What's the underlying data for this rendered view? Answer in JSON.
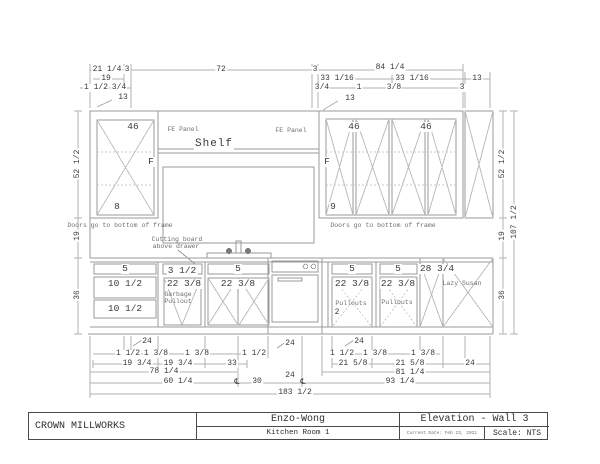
{
  "title_block": {
    "company": "CROWN MILLWORKS",
    "client": "Enzo-Wong",
    "room": "Kitchen Room 1",
    "sheet": "Elevation - Wall 3",
    "date": "Current Date: Feb 23, 2021",
    "scale": "Scale: NTS"
  },
  "dims_top": {
    "a": "21 1/4",
    "b": "3",
    "c": "72",
    "d": "3",
    "e": "84 1/4",
    "f": "19",
    "g": "33 1/16",
    "h": "33 1/16",
    "i": "13",
    "j": "1 1/2",
    "k": "3/4",
    "l": "3/4",
    "m": "1",
    "n": "3/8",
    "o": "3",
    "p": "13",
    "q": "13"
  },
  "dims_left": {
    "upper": "52 1/2",
    "gap": "19",
    "base": "36"
  },
  "dims_right": {
    "upper": "52 1/2",
    "gap": "19",
    "base": "36",
    "total": "107 1/2"
  },
  "dims_bottom": {
    "lead1": "24",
    "lead2": "24",
    "lead3": "24",
    "r1a": "1 1/2",
    "r1b": "1 3/8",
    "r1c": "1 3/8",
    "r1d": "1 1/2",
    "r1e": "1 1/2",
    "r1f": "1 3/8",
    "r1g": "1 3/8",
    "r2a": "19 3/4",
    "r2b": "19 3/4",
    "r2c": "33",
    "r2d": "21 5/8",
    "r2e": "21 5/8",
    "r2f": "24",
    "r3a": "78 1/4",
    "r3b": "81 1/4",
    "r4a": "60 1/4",
    "r4cl1": "℄",
    "r4b": "30",
    "r4c": "24",
    "r4cl2": "℄",
    "r4d": "93 1/4",
    "r5": "183 1/2"
  },
  "cabinets": {
    "upper_left": {
      "size": "46",
      "f": "F",
      "id": "8"
    },
    "upper_right": {
      "size1": "46",
      "size2": "46",
      "f": "F",
      "id": "9"
    },
    "shelf": "Shelf",
    "fe_left": "FE Panel",
    "fe_right": "FE Panel",
    "note_left": "Doors go to bottom of frame",
    "note_right": "Doors go to bottom of frame",
    "cutting1": "Cutting board",
    "cutting2": "above drawer",
    "base": {
      "d5a": "5",
      "d10a": "10 1/2",
      "d10b": "10 1/2",
      "d3": "3 1/2",
      "w22a": "22 3/8",
      "garb1": "Garbage",
      "garb2": "Pullout",
      "d5b": "5",
      "w22b": "22 3/8",
      "d5c": "5",
      "w22c": "22 3/8",
      "pull1": "Pullouts",
      "pull1n": "2",
      "d5d": "5",
      "w22d": "22 3/8",
      "pull2": "Pullouts",
      "w28": "28 3/4",
      "lazy": "Lazy Susan"
    }
  },
  "colors": {
    "line": "#9a9a9a",
    "dim_line": "#b0b0b0",
    "text": "#3a3a3a"
  }
}
